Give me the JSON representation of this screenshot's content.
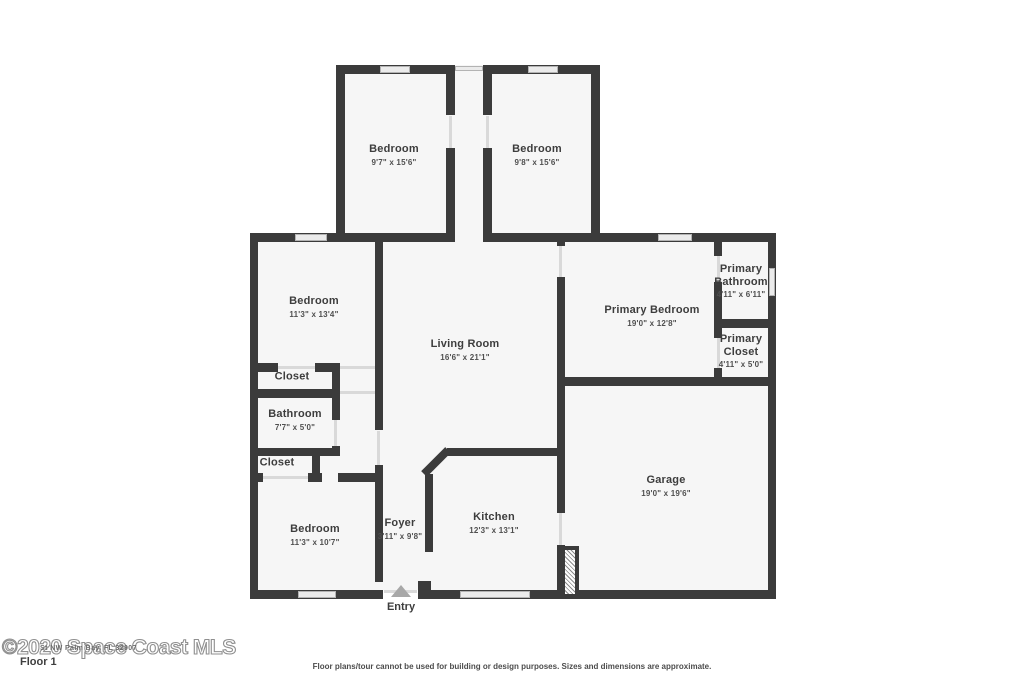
{
  "page": {
    "floor_label": "Floor 1",
    "watermark": "©2020 Space Coast MLS",
    "address_overlay": "St NW Palm Bay, FL 32907",
    "disclaimer": "Floor plans/tour cannot be used for building or design purposes. Sizes and dimensions are approximate.",
    "entry_label": "Entry"
  },
  "colors": {
    "wall": "#3b3b3b",
    "floor": "#f6f6f6",
    "label": "#3d3d3d",
    "dims": "#4f4f4f",
    "winfill": "#ebebeb",
    "winborder": "#b3b3b3",
    "doorline": "#d9d9d9",
    "tri": "#a8a8a8"
  },
  "rooms": [
    {
      "id": "bedroom-top-left",
      "name": "Bedroom",
      "dims": "9'7\" x 15'6\"",
      "x": 394,
      "y": 155
    },
    {
      "id": "bedroom-top-right",
      "name": "Bedroom",
      "dims": "9'8\" x 15'6\"",
      "x": 537,
      "y": 155
    },
    {
      "id": "bedroom-left",
      "name": "Bedroom",
      "dims": "11'3\" x 13'4\"",
      "x": 314,
      "y": 307
    },
    {
      "id": "living-room",
      "name": "Living Room",
      "dims": "16'6\" x 21'1\"",
      "x": 465,
      "y": 350
    },
    {
      "id": "primary-bedroom",
      "name": "Primary Bedroom",
      "dims": "19'0\" x 12'8\"",
      "x": 652,
      "y": 316
    },
    {
      "id": "primary-bathroom",
      "name": "Primary Bathroom",
      "dims": "4'11\" x 6'11\"",
      "x": 741,
      "y": 281,
      "wrap": true
    },
    {
      "id": "primary-closet",
      "name": "Primary Closet",
      "dims": "4'11\" x 5'0\"",
      "x": 741,
      "y": 351,
      "wrap": true
    },
    {
      "id": "closet-upper",
      "name": "Closet",
      "dims": "",
      "x": 292,
      "y": 377
    },
    {
      "id": "bathroom",
      "name": "Bathroom",
      "dims": "7'7\" x 5'0\"",
      "x": 295,
      "y": 420
    },
    {
      "id": "closet-lower",
      "name": "Closet",
      "dims": "",
      "x": 277,
      "y": 463
    },
    {
      "id": "bedroom-bottom",
      "name": "Bedroom",
      "dims": "11'3\" x 10'7\"",
      "x": 315,
      "y": 535
    },
    {
      "id": "foyer",
      "name": "Foyer",
      "dims": "3'11\" x 9'8\"",
      "x": 400,
      "y": 529
    },
    {
      "id": "kitchen",
      "name": "Kitchen",
      "dims": "12'3\" x 13'1\"",
      "x": 494,
      "y": 523
    },
    {
      "id": "garage",
      "name": "Garage",
      "dims": "19'0\" x 19'6\"",
      "x": 666,
      "y": 486
    }
  ]
}
